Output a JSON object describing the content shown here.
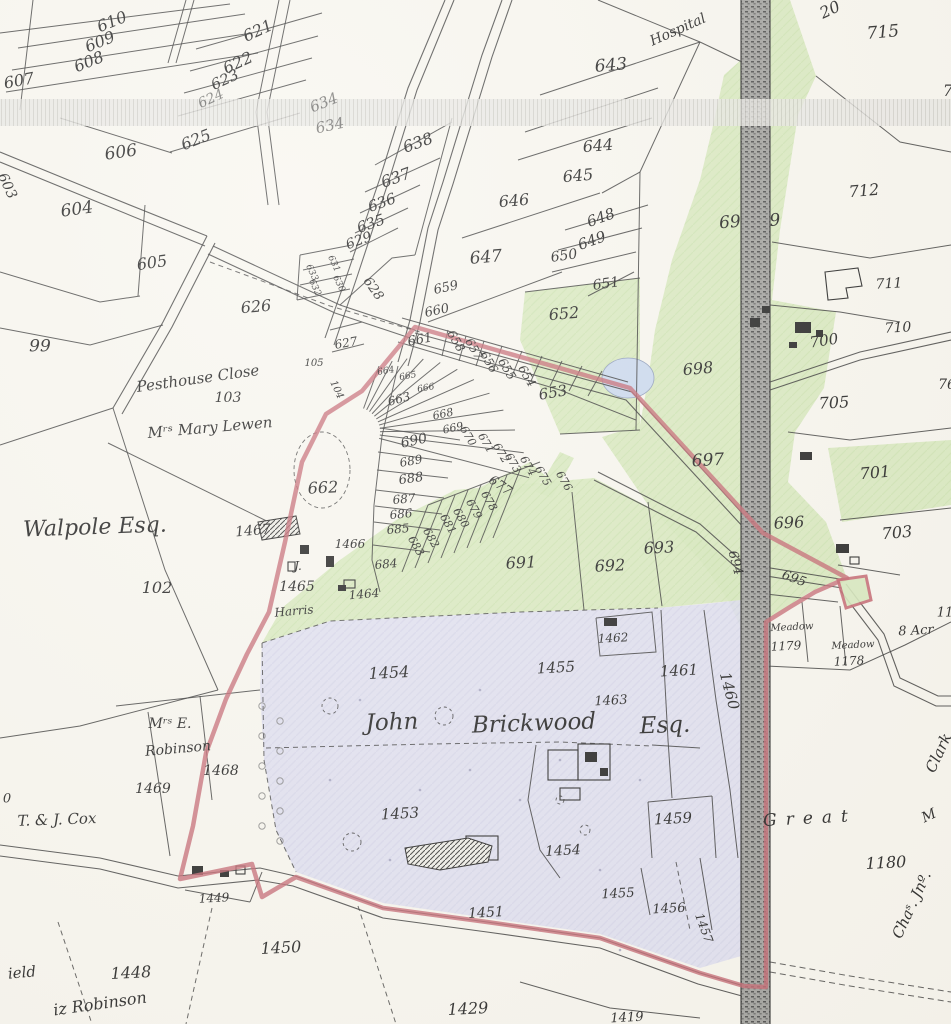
{
  "map": {
    "description": "Historical cadastral estate map with numbered land parcels, owner names, railway, and red estate boundary",
    "colors": {
      "paper": "#f8f6ef",
      "ink": "#1b1b1b",
      "meadow_green": "#d5e8ba",
      "estate_lavender": "#dcdcf0",
      "pond_blue": "#c9d8ee",
      "boundary_red": "#c2606b",
      "railway_grey": "#8a8a88",
      "scan_band": "#e9e8e4"
    },
    "labels": [
      {
        "t": "20",
        "x": 830,
        "y": 10,
        "r": -25,
        "s": 16,
        "c": "n"
      },
      {
        "t": "610",
        "x": 112,
        "y": 22,
        "r": -22,
        "s": 16,
        "c": "n"
      },
      {
        "t": "609",
        "x": 100,
        "y": 42,
        "r": -22,
        "s": 16,
        "c": "n"
      },
      {
        "t": "608",
        "x": 89,
        "y": 62,
        "r": -22,
        "s": 16,
        "c": "n"
      },
      {
        "t": "607",
        "x": 19,
        "y": 81,
        "r": -10,
        "s": 16,
        "c": "n"
      },
      {
        "t": "621",
        "x": 258,
        "y": 31,
        "r": -25,
        "s": 16,
        "c": "n"
      },
      {
        "t": "622",
        "x": 238,
        "y": 63,
        "r": -25,
        "s": 16,
        "c": "n"
      },
      {
        "t": "623",
        "x": 225,
        "y": 80,
        "r": -25,
        "s": 15,
        "c": "n"
      },
      {
        "t": "624",
        "x": 211,
        "y": 99,
        "r": -25,
        "s": 14,
        "c": "n dim"
      },
      {
        "t": "625",
        "x": 196,
        "y": 140,
        "r": -22,
        "s": 16,
        "c": "n"
      },
      {
        "t": "606",
        "x": 121,
        "y": 153,
        "r": -8,
        "s": 17,
        "c": "n"
      },
      {
        "t": "603",
        "x": 7,
        "y": 186,
        "r": 65,
        "s": 14,
        "c": "n"
      },
      {
        "t": "604",
        "x": 77,
        "y": 210,
        "r": -8,
        "s": 17,
        "c": "n"
      },
      {
        "t": "605",
        "x": 152,
        "y": 263,
        "r": -8,
        "s": 16,
        "c": "n"
      },
      {
        "t": "99",
        "x": 40,
        "y": 347,
        "r": 0,
        "s": 17,
        "c": "n"
      },
      {
        "t": "626",
        "x": 256,
        "y": 307,
        "r": -5,
        "s": 16,
        "c": "n"
      },
      {
        "t": "634",
        "x": 324,
        "y": 103,
        "r": -22,
        "s": 15,
        "c": "n dim"
      },
      {
        "t": "634",
        "x": 330,
        "y": 126,
        "r": -12,
        "s": 15,
        "c": "n dim"
      },
      {
        "t": "638",
        "x": 418,
        "y": 143,
        "r": -20,
        "s": 16,
        "c": "n"
      },
      {
        "t": "637",
        "x": 396,
        "y": 178,
        "r": -20,
        "s": 16,
        "c": "n"
      },
      {
        "t": "636",
        "x": 382,
        "y": 203,
        "r": -20,
        "s": 15,
        "c": "n"
      },
      {
        "t": "635",
        "x": 371,
        "y": 224,
        "r": -20,
        "s": 15,
        "c": "n"
      },
      {
        "t": "629",
        "x": 359,
        "y": 241,
        "r": -20,
        "s": 14,
        "c": "n"
      },
      {
        "t": "633",
        "x": 311,
        "y": 273,
        "r": 65,
        "s": 9,
        "c": "n"
      },
      {
        "t": "631",
        "x": 333,
        "y": 264,
        "r": 65,
        "s": 9,
        "c": "n"
      },
      {
        "t": "632",
        "x": 314,
        "y": 288,
        "r": 65,
        "s": 9,
        "c": "n"
      },
      {
        "t": "630",
        "x": 338,
        "y": 284,
        "r": 65,
        "s": 9,
        "c": "n"
      },
      {
        "t": "628",
        "x": 373,
        "y": 289,
        "r": 55,
        "s": 13,
        "c": "n"
      },
      {
        "t": "627",
        "x": 346,
        "y": 343,
        "r": -10,
        "s": 12,
        "c": "n"
      },
      {
        "t": "105",
        "x": 314,
        "y": 364,
        "r": 0,
        "s": 10,
        "c": "n"
      },
      {
        "t": "104",
        "x": 336,
        "y": 390,
        "r": 65,
        "s": 10,
        "c": "n"
      },
      {
        "t": "643",
        "x": 611,
        "y": 66,
        "r": -5,
        "s": 17,
        "c": "n"
      },
      {
        "t": "Hospital",
        "x": 678,
        "y": 30,
        "r": -24,
        "s": 14,
        "c": "it"
      },
      {
        "t": "644",
        "x": 598,
        "y": 146,
        "r": -5,
        "s": 16,
        "c": "n"
      },
      {
        "t": "645",
        "x": 578,
        "y": 176,
        "r": -5,
        "s": 16,
        "c": "n"
      },
      {
        "t": "646",
        "x": 514,
        "y": 201,
        "r": -5,
        "s": 16,
        "c": "n"
      },
      {
        "t": "647",
        "x": 486,
        "y": 258,
        "r": -5,
        "s": 17,
        "c": "n"
      },
      {
        "t": "648",
        "x": 601,
        "y": 218,
        "r": -20,
        "s": 15,
        "c": "n"
      },
      {
        "t": "649",
        "x": 592,
        "y": 241,
        "r": -20,
        "s": 15,
        "c": "n"
      },
      {
        "t": "650",
        "x": 564,
        "y": 256,
        "r": -8,
        "s": 14,
        "c": "n"
      },
      {
        "t": "651",
        "x": 606,
        "y": 284,
        "r": -8,
        "s": 14,
        "c": "n"
      },
      {
        "t": "652",
        "x": 564,
        "y": 314,
        "r": -5,
        "s": 16,
        "c": "n"
      },
      {
        "t": "653",
        "x": 553,
        "y": 393,
        "r": -10,
        "s": 15,
        "c": "n"
      },
      {
        "t": "659",
        "x": 446,
        "y": 288,
        "r": -12,
        "s": 13,
        "c": "n"
      },
      {
        "t": "660",
        "x": 437,
        "y": 311,
        "r": -12,
        "s": 13,
        "c": "n"
      },
      {
        "t": "661",
        "x": 420,
        "y": 340,
        "r": -10,
        "s": 13,
        "c": "n"
      },
      {
        "t": "658",
        "x": 456,
        "y": 341,
        "r": 60,
        "s": 12,
        "c": "n"
      },
      {
        "t": "657",
        "x": 474,
        "y": 349,
        "r": 60,
        "s": 12,
        "c": "n"
      },
      {
        "t": "656",
        "x": 489,
        "y": 362,
        "r": 60,
        "s": 12,
        "c": "n"
      },
      {
        "t": "655",
        "x": 507,
        "y": 369,
        "r": 60,
        "s": 12,
        "c": "n"
      },
      {
        "t": "654",
        "x": 527,
        "y": 376,
        "r": 60,
        "s": 12,
        "c": "n"
      },
      {
        "t": "715",
        "x": 883,
        "y": 33,
        "r": -5,
        "s": 17,
        "c": "n"
      },
      {
        "t": "712",
        "x": 864,
        "y": 191,
        "r": -5,
        "s": 16,
        "c": "n"
      },
      {
        "t": "7",
        "x": 948,
        "y": 91,
        "r": 0,
        "s": 16,
        "c": "n"
      },
      {
        "t": "69",
        "x": 730,
        "y": 223,
        "r": -5,
        "s": 17,
        "c": "n"
      },
      {
        "t": "9",
        "x": 775,
        "y": 221,
        "r": -5,
        "s": 17,
        "c": "n"
      },
      {
        "t": "698",
        "x": 698,
        "y": 369,
        "r": -5,
        "s": 16,
        "c": "n"
      },
      {
        "t": "711",
        "x": 889,
        "y": 284,
        "r": -3,
        "s": 14,
        "c": "n"
      },
      {
        "t": "710",
        "x": 898,
        "y": 328,
        "r": -3,
        "s": 14,
        "c": "n"
      },
      {
        "t": "700",
        "x": 824,
        "y": 341,
        "r": -8,
        "s": 15,
        "c": "n"
      },
      {
        "t": "705",
        "x": 834,
        "y": 403,
        "r": -3,
        "s": 16,
        "c": "n"
      },
      {
        "t": "697",
        "x": 708,
        "y": 461,
        "r": -3,
        "s": 17,
        "c": "n"
      },
      {
        "t": "701",
        "x": 875,
        "y": 473,
        "r": -5,
        "s": 16,
        "c": "n"
      },
      {
        "t": "696",
        "x": 789,
        "y": 523,
        "r": -3,
        "s": 16,
        "c": "n"
      },
      {
        "t": "703",
        "x": 897,
        "y": 533,
        "r": -5,
        "s": 16,
        "c": "n"
      },
      {
        "t": "693",
        "x": 659,
        "y": 548,
        "r": -3,
        "s": 16,
        "c": "n"
      },
      {
        "t": "694",
        "x": 735,
        "y": 563,
        "r": 75,
        "s": 13,
        "c": "n"
      },
      {
        "t": "695",
        "x": 794,
        "y": 579,
        "r": 20,
        "s": 13,
        "c": "n"
      },
      {
        "t": "692",
        "x": 610,
        "y": 566,
        "r": -3,
        "s": 16,
        "c": "n"
      },
      {
        "t": "691",
        "x": 521,
        "y": 563,
        "r": -3,
        "s": 16,
        "c": "n"
      },
      {
        "t": "76",
        "x": 947,
        "y": 385,
        "r": 0,
        "s": 14,
        "c": "n"
      },
      {
        "t": "662",
        "x": 323,
        "y": 488,
        "r": -3,
        "s": 16,
        "c": "n"
      },
      {
        "t": "690",
        "x": 414,
        "y": 441,
        "r": -12,
        "s": 14,
        "c": "n"
      },
      {
        "t": "689",
        "x": 411,
        "y": 461,
        "r": -10,
        "s": 12,
        "c": "n"
      },
      {
        "t": "688",
        "x": 411,
        "y": 479,
        "r": -8,
        "s": 13,
        "c": "n"
      },
      {
        "t": "687",
        "x": 404,
        "y": 499,
        "r": -5,
        "s": 12,
        "c": "n"
      },
      {
        "t": "686",
        "x": 401,
        "y": 514,
        "r": -5,
        "s": 12,
        "c": "n"
      },
      {
        "t": "685",
        "x": 398,
        "y": 529,
        "r": -5,
        "s": 12,
        "c": "n"
      },
      {
        "t": "684",
        "x": 386,
        "y": 564,
        "r": -5,
        "s": 12,
        "c": "n"
      },
      {
        "t": "683",
        "x": 416,
        "y": 546,
        "r": 60,
        "s": 11,
        "c": "n"
      },
      {
        "t": "682",
        "x": 431,
        "y": 538,
        "r": 60,
        "s": 11,
        "c": "n"
      },
      {
        "t": "681",
        "x": 448,
        "y": 524,
        "r": 60,
        "s": 11,
        "c": "n"
      },
      {
        "t": "680",
        "x": 461,
        "y": 518,
        "r": 60,
        "s": 11,
        "c": "n"
      },
      {
        "t": "679",
        "x": 474,
        "y": 509,
        "r": 60,
        "s": 11,
        "c": "n"
      },
      {
        "t": "678",
        "x": 489,
        "y": 501,
        "r": 60,
        "s": 11,
        "c": "n"
      },
      {
        "t": "677",
        "x": 500,
        "y": 486,
        "r": 35,
        "s": 13,
        "c": "n"
      },
      {
        "t": "676",
        "x": 564,
        "y": 481,
        "r": 60,
        "s": 11,
        "c": "n"
      },
      {
        "t": "675",
        "x": 543,
        "y": 476,
        "r": 60,
        "s": 11,
        "c": "n"
      },
      {
        "t": "664",
        "x": 386,
        "y": 372,
        "r": -10,
        "s": 9,
        "c": "n"
      },
      {
        "t": "665",
        "x": 408,
        "y": 377,
        "r": -10,
        "s": 9,
        "c": "n"
      },
      {
        "t": "666",
        "x": 426,
        "y": 389,
        "r": -10,
        "s": 9,
        "c": "n"
      },
      {
        "t": "663",
        "x": 399,
        "y": 399,
        "r": -15,
        "s": 12,
        "c": "n"
      },
      {
        "t": "668",
        "x": 443,
        "y": 414,
        "r": -12,
        "s": 11,
        "c": "n"
      },
      {
        "t": "669",
        "x": 453,
        "y": 428,
        "r": -12,
        "s": 11,
        "c": "n"
      },
      {
        "t": "670",
        "x": 468,
        "y": 436,
        "r": 60,
        "s": 11,
        "c": "n"
      },
      {
        "t": "671",
        "x": 486,
        "y": 443,
        "r": 60,
        "s": 11,
        "c": "n"
      },
      {
        "t": "672",
        "x": 501,
        "y": 453,
        "r": 60,
        "s": 11,
        "c": "n"
      },
      {
        "t": "673",
        "x": 513,
        "y": 463,
        "r": 60,
        "s": 11,
        "c": "n"
      },
      {
        "t": "674",
        "x": 528,
        "y": 466,
        "r": 60,
        "s": 11,
        "c": "n"
      },
      {
        "t": "Pesthouse Close",
        "x": 198,
        "y": 379,
        "r": -8,
        "s": 15,
        "c": "it"
      },
      {
        "t": "103",
        "x": 228,
        "y": 398,
        "r": 0,
        "s": 14,
        "c": "n"
      },
      {
        "t": "Mʳˢ Mary Lewen",
        "x": 210,
        "y": 428,
        "r": -5,
        "s": 15,
        "c": "it"
      },
      {
        "t": "Walpole Esq.",
        "x": 95,
        "y": 528,
        "r": -2,
        "s": 22,
        "c": "it"
      },
      {
        "t": "1467",
        "x": 253,
        "y": 531,
        "r": -5,
        "s": 14,
        "c": "n"
      },
      {
        "t": "102",
        "x": 157,
        "y": 588,
        "r": 0,
        "s": 16,
        "c": "n"
      },
      {
        "t": "1466",
        "x": 350,
        "y": 544,
        "r": 0,
        "s": 12,
        "c": "n"
      },
      {
        "t": "J.",
        "x": 298,
        "y": 566,
        "r": 0,
        "s": 12,
        "c": "n"
      },
      {
        "t": "1465",
        "x": 297,
        "y": 587,
        "r": 0,
        "s": 14,
        "c": "n"
      },
      {
        "t": "Harris",
        "x": 294,
        "y": 611,
        "r": -5,
        "s": 12,
        "c": "it"
      },
      {
        "t": "1464",
        "x": 364,
        "y": 594,
        "r": -5,
        "s": 12,
        "c": "n"
      },
      {
        "t": "Mʳˢ E.",
        "x": 170,
        "y": 724,
        "r": 0,
        "s": 14,
        "c": "it"
      },
      {
        "t": "Robinson",
        "x": 178,
        "y": 749,
        "r": -5,
        "s": 14,
        "c": "it"
      },
      {
        "t": "1468",
        "x": 221,
        "y": 771,
        "r": 0,
        "s": 14,
        "c": "n"
      },
      {
        "t": "1469",
        "x": 153,
        "y": 789,
        "r": 0,
        "s": 14,
        "c": "n"
      },
      {
        "t": "0",
        "x": 7,
        "y": 799,
        "r": 0,
        "s": 13,
        "c": "n"
      },
      {
        "t": "T. & J. Cox",
        "x": 57,
        "y": 820,
        "r": -2,
        "s": 15,
        "c": "it"
      },
      {
        "t": "1449",
        "x": 214,
        "y": 898,
        "r": -3,
        "s": 12,
        "c": "n"
      },
      {
        "t": "1450",
        "x": 281,
        "y": 948,
        "r": -3,
        "s": 16,
        "c": "n"
      },
      {
        "t": "1448",
        "x": 131,
        "y": 973,
        "r": -3,
        "s": 16,
        "c": "n"
      },
      {
        "t": "ield",
        "x": 22,
        "y": 973,
        "r": -5,
        "s": 15,
        "c": "it"
      },
      {
        "t": "iz Robinson",
        "x": 100,
        "y": 1004,
        "r": -8,
        "s": 16,
        "c": "it"
      },
      {
        "t": "1429",
        "x": 468,
        "y": 1009,
        "r": -3,
        "s": 16,
        "c": "n"
      },
      {
        "t": "1451",
        "x": 486,
        "y": 913,
        "r": -3,
        "s": 14,
        "c": "n"
      },
      {
        "t": "1453",
        "x": 400,
        "y": 814,
        "r": -3,
        "s": 15,
        "c": "n"
      },
      {
        "t": "1454",
        "x": 563,
        "y": 851,
        "r": -3,
        "s": 14,
        "c": "n"
      },
      {
        "t": "1455",
        "x": 618,
        "y": 894,
        "r": -3,
        "s": 13,
        "c": "n"
      },
      {
        "t": "1456",
        "x": 669,
        "y": 909,
        "r": -3,
        "s": 13,
        "c": "n"
      },
      {
        "t": "1457",
        "x": 704,
        "y": 928,
        "r": 70,
        "s": 12,
        "c": "n"
      },
      {
        "t": "1419",
        "x": 627,
        "y": 1018,
        "r": -3,
        "s": 13,
        "c": "n"
      },
      {
        "t": "1459",
        "x": 673,
        "y": 819,
        "r": -3,
        "s": 15,
        "c": "n"
      },
      {
        "t": "Great",
        "x": 810,
        "y": 819,
        "r": -3,
        "s": 17,
        "c": "sc"
      },
      {
        "t": "1180",
        "x": 886,
        "y": 863,
        "r": -3,
        "s": 16,
        "c": "n"
      },
      {
        "t": "Chaˢ. Jnº.",
        "x": 912,
        "y": 905,
        "r": -65,
        "s": 15,
        "c": "it"
      },
      {
        "t": "Clark",
        "x": 939,
        "y": 753,
        "r": -65,
        "s": 15,
        "c": "it"
      },
      {
        "t": "M",
        "x": 929,
        "y": 816,
        "r": -25,
        "s": 14,
        "c": "it"
      },
      {
        "t": "1454",
        "x": 389,
        "y": 673,
        "r": -3,
        "s": 16,
        "c": "n"
      },
      {
        "t": "1455",
        "x": 556,
        "y": 668,
        "r": -3,
        "s": 15,
        "c": "n"
      },
      {
        "t": "1462",
        "x": 613,
        "y": 638,
        "r": -3,
        "s": 12,
        "c": "n"
      },
      {
        "t": "1461",
        "x": 679,
        "y": 671,
        "r": -3,
        "s": 15,
        "c": "n"
      },
      {
        "t": "1460",
        "x": 729,
        "y": 691,
        "r": 75,
        "s": 15,
        "c": "n"
      },
      {
        "t": "1463",
        "x": 611,
        "y": 701,
        "r": -3,
        "s": 13,
        "c": "n"
      },
      {
        "t": "John",
        "x": 392,
        "y": 723,
        "r": -2,
        "s": 23,
        "c": "it"
      },
      {
        "t": "Brickwood",
        "x": 534,
        "y": 724,
        "r": -2,
        "s": 23,
        "c": "it"
      },
      {
        "t": "Esq.",
        "x": 665,
        "y": 726,
        "r": -2,
        "s": 23,
        "c": "it"
      },
      {
        "t": "Meadow",
        "x": 792,
        "y": 628,
        "r": -3,
        "s": 10,
        "c": "it"
      },
      {
        "t": "1179",
        "x": 786,
        "y": 646,
        "r": -3,
        "s": 12,
        "c": "n"
      },
      {
        "t": "Meadow",
        "x": 853,
        "y": 646,
        "r": -3,
        "s": 10,
        "c": "it"
      },
      {
        "t": "1178",
        "x": 849,
        "y": 661,
        "r": -3,
        "s": 12,
        "c": "n"
      },
      {
        "t": "11",
        "x": 945,
        "y": 613,
        "r": 0,
        "s": 13,
        "c": "n"
      },
      {
        "t": "8 Acr",
        "x": 916,
        "y": 631,
        "r": -3,
        "s": 13,
        "c": "it"
      }
    ]
  }
}
